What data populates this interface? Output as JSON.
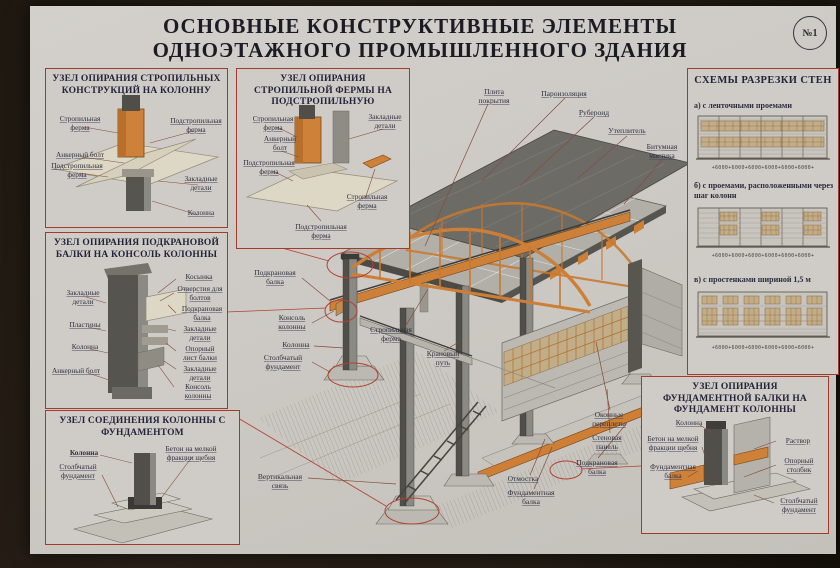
{
  "poster": {
    "title_line1": "ОСНОВНЫЕ КОНСТРУКТИВНЫЕ ЭЛЕМЕНТЫ",
    "title_line2": "ОДНОЭТАЖНОГО ПРОМЫШЛЕННОГО ЗДАНИЯ",
    "badge": "№1",
    "accent_color": "#a33b2c",
    "paper_color": "#cdcac5",
    "orange_color": "#cd7f36"
  },
  "node_boxes": [
    {
      "title": "УЗЕЛ ОПИРАНИЯ СТРОПИЛЬНЫХ КОНСТРУКЦИЙ НА КОЛОННУ",
      "labels": [
        "Стропильная ферма",
        "Подстропильная ферма",
        "Анкерный болт",
        "Подстропильная ферма",
        "Закладные детали",
        "Колонна"
      ]
    },
    {
      "title": "УЗЕЛ ОПИРАНИЯ СТРОПИЛЬНОЙ ФЕРМЫ НА ПОДСТРОПИЛЬНУЮ",
      "labels": [
        "Стропильная ферма",
        "Анкерный болт",
        "Подстропильная ферма",
        "Закладные детали",
        "Стропильная ферма",
        "Подстропильная ферма"
      ]
    },
    {
      "title": "УЗЕЛ ОПИРАНИЯ ПОДКРАНОВОЙ БАЛКИ НА КОНСОЛЬ КОЛОННЫ",
      "labels": [
        "Закладные детали",
        "Пластины",
        "Колонна",
        "Анкерный болт",
        "Косынка",
        "Отверстия для болтов",
        "Подкрановая балка",
        "Закладные детали",
        "Опорный лист балки",
        "Закладные детали",
        "Консоль колонны"
      ]
    },
    {
      "title": "УЗЕЛ СОЕДИНЕНИЯ КОЛОННЫ С ФУНДАМЕНТОМ",
      "labels": [
        "Колонна",
        "Столбчатый фундамент",
        "Бетон на мелкой фракции щебня"
      ]
    },
    {
      "title": "УЗЕЛ ОПИРАНИЯ ФУНДАМЕНТНОЙ БАЛКИ НА ФУНДАМЕНТ КОЛОННЫ",
      "labels": [
        "Колонна",
        "Бетон на мелкой фракции щебня",
        "Фундаментная балка",
        "Раствор",
        "Опорный столбик",
        "Столбчатый фундамент"
      ]
    }
  ],
  "wall_schemes": {
    "title": "СХЕМЫ РАЗРЕЗКИ СТЕН",
    "items": [
      {
        "caption": "а) с ленточными проемами",
        "dims": "+6000+6000+6000+6000+6000+6000+"
      },
      {
        "caption": "б) с проемами, расположенными через шаг колонн",
        "dims": "+6000+6000+6000+6000+6000+6000+"
      },
      {
        "caption": "в) с простенками шириной 1,5 м",
        "dims": "+6000+6000+6000+6000+6000+6000+"
      }
    ]
  },
  "building": {
    "labels": [
      "Плита покрытия",
      "Пароизоляция",
      "Рубероид",
      "Утеплитель",
      "Битумная мастика",
      "Стропильная ферма",
      "Крановый путь",
      "Подкрановая балка",
      "Консоль колонны",
      "Колонна",
      "Столбчатый фундамент",
      "Оконные переплеты",
      "Стеновая панель",
      "Подкрановая балка",
      "Отмостка",
      "Фундаментная балка",
      "Вертикальная связь"
    ]
  }
}
